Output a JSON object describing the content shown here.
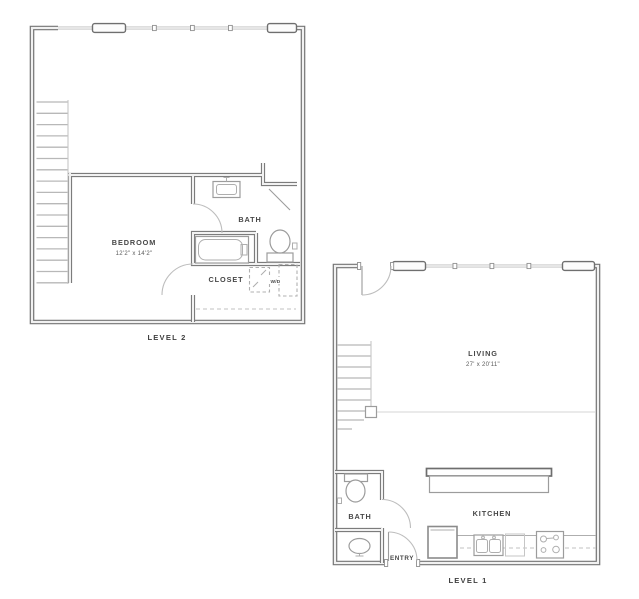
{
  "title": "Two-level apartment floor plan",
  "colors": {
    "background": "#ffffff",
    "wall": "#747474",
    "fixture": "#9c9c9c",
    "light_line": "#c4c4c4",
    "text": "#474747"
  },
  "level2": {
    "label": "LEVEL 2",
    "bedroom": {
      "name": "BEDROOM",
      "dims": "12'2\" x 14'2\""
    },
    "bath": {
      "name": "BATH"
    },
    "closet": {
      "name": "CLOSET"
    },
    "washer_dryer": {
      "name": "W/D"
    }
  },
  "level1": {
    "label": "LEVEL 1",
    "living": {
      "name": "LIVING",
      "dims": "27' x 20'11\""
    },
    "bath": {
      "name": "BATH"
    },
    "kitchen": {
      "name": "KITCHEN"
    },
    "entry": {
      "name": "ENTRY"
    }
  }
}
